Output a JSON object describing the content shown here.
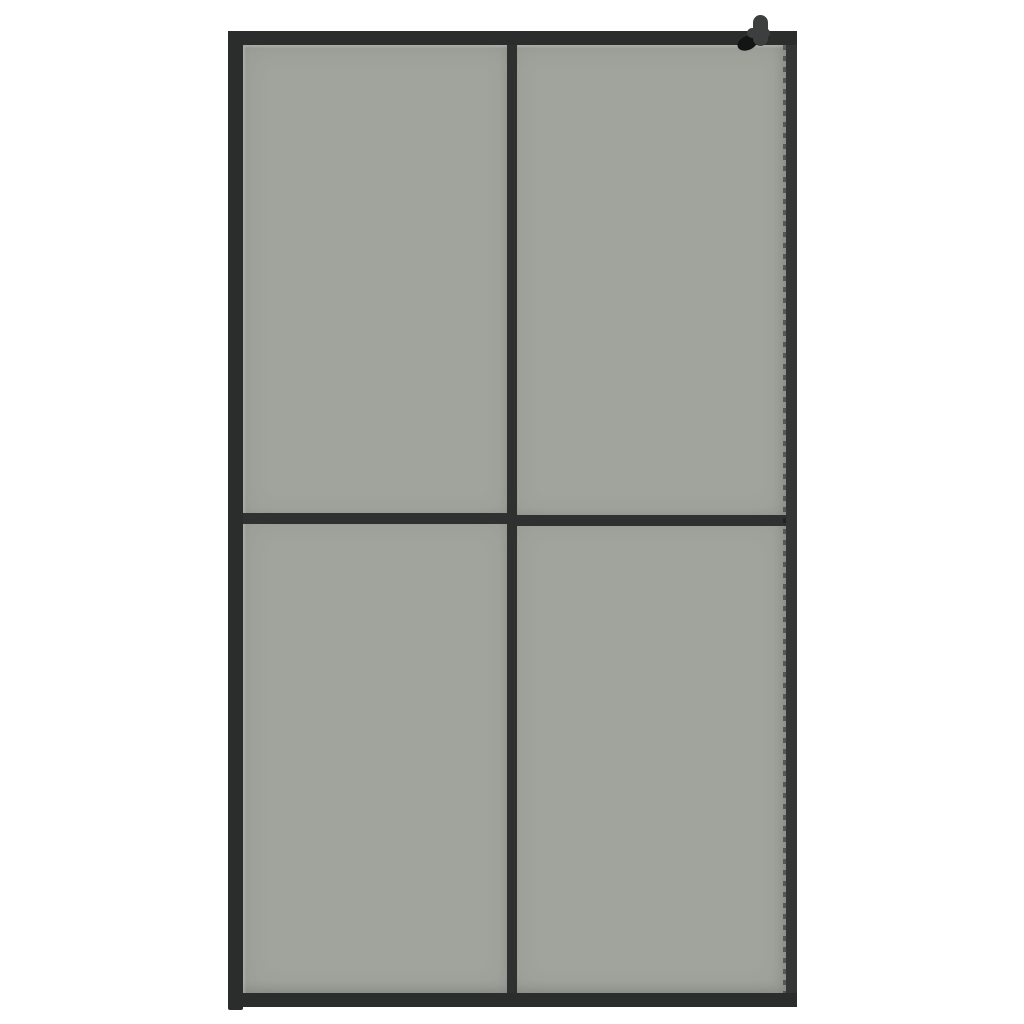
{
  "scene": {
    "description": "Product photo of a walk-in shower screen: black metal frame, four smoked grey glass panes in a 2 x 2 grid, wall-mount bracket knob at the top right, on a plain white background",
    "pane_count": 4,
    "grid": "2 x 2"
  },
  "colors": {
    "background": "#ffffff",
    "glass": "#a1a49d",
    "frame": "#2b2d2c",
    "frame_right": "#333635",
    "mullion": "#2f3130",
    "bracket": "#3c3f3e",
    "screw_shadow": "#131514",
    "glass_highlight": "#c3c5c0"
  }
}
